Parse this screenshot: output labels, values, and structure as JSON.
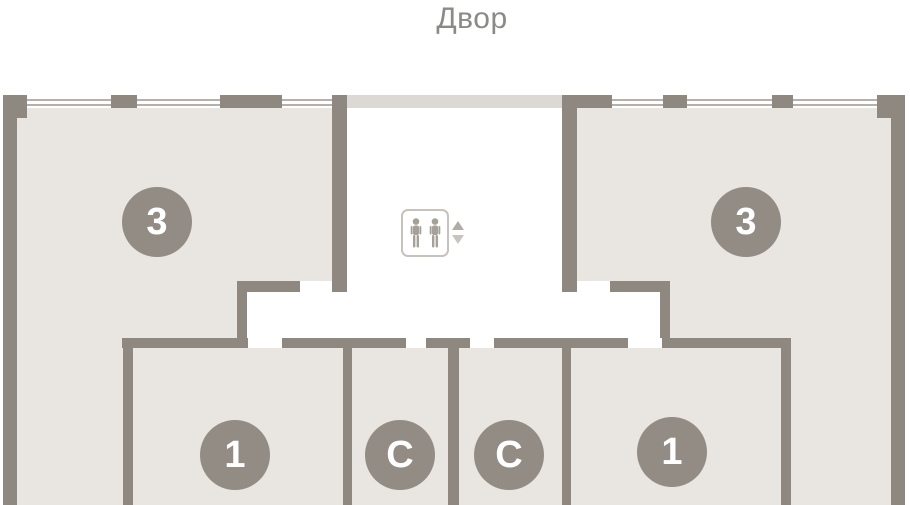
{
  "title": "Двор",
  "colors": {
    "wall": "#8f8881",
    "room": "#e9e5e1",
    "corridor_band": "#dcd8d4",
    "window_line": "#b5b0aa",
    "badge": "#938c84",
    "badge_text": "#ffffff",
    "title_text": "#8a8a87",
    "elevator_border": "#c7c2bc",
    "elevator_person": "#a6a099",
    "arrow_up": "#b2aca6",
    "arrow_down": "#c9c4be"
  },
  "units": [
    {
      "label": "3"
    },
    {
      "label": "3"
    },
    {
      "label": "1"
    },
    {
      "label": "С"
    },
    {
      "label": "С"
    },
    {
      "label": "1"
    }
  ]
}
